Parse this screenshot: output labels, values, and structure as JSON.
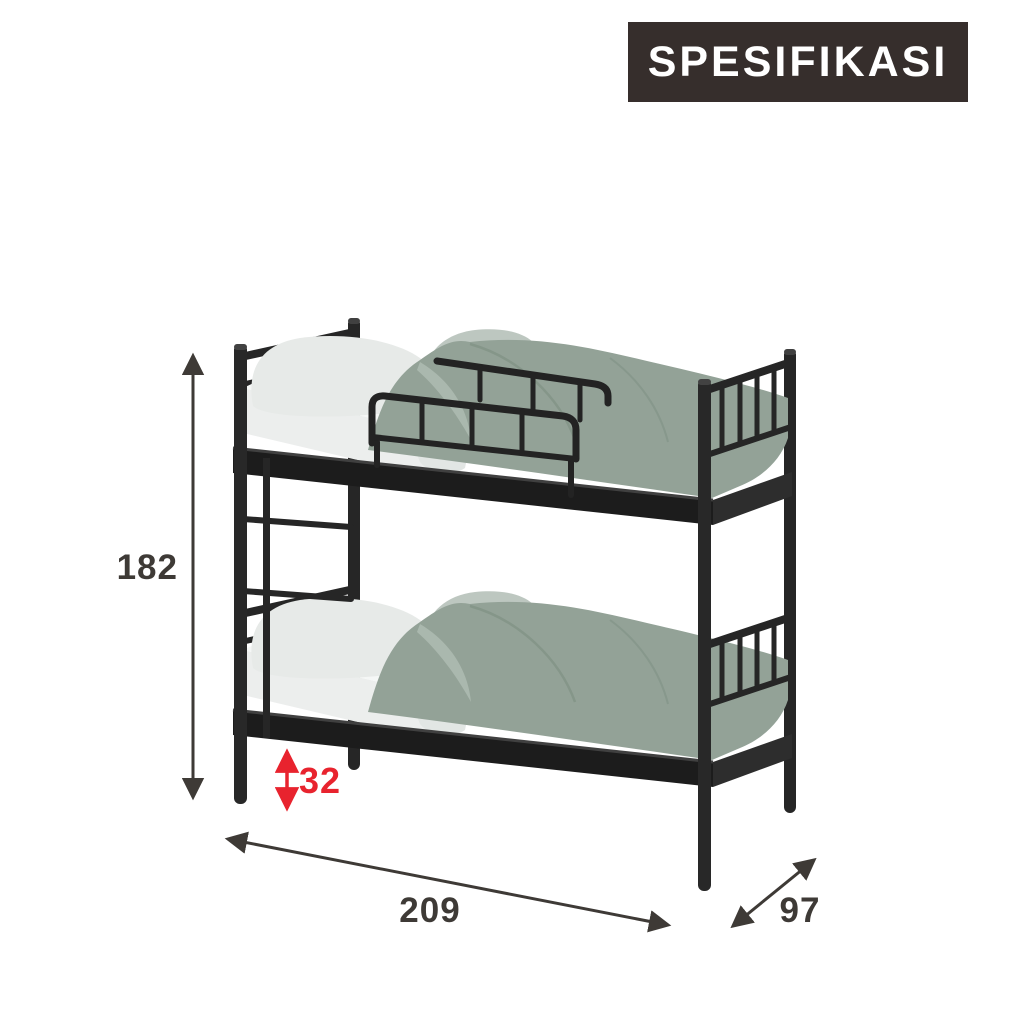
{
  "badge": {
    "label": "SPESIFIKASI"
  },
  "dimensions": {
    "height": "182",
    "clearance": "32",
    "length": "209",
    "depth": "97"
  },
  "colors": {
    "dimension_dark": "#3e3a36",
    "accent_red": "#e8232e",
    "badge_bg": "#362e2c",
    "badge_text": "#ffffff",
    "frame_black": "#262626",
    "frame_rail_dark": "#1c1c1c",
    "duvet_green": "#93a297",
    "pillow_white": "#e7eae8",
    "pillow_back_gray": "#bdc7c0",
    "mattress_white": "#eceeed",
    "background": "#ffffff"
  },
  "icons": {
    "height_arrow": "double-headed-vertical-arrow",
    "clearance_arrow": "double-headed-vertical-arrow-red",
    "length_arrow": "double-headed-diagonal-arrow",
    "depth_arrow": "double-headed-diagonal-arrow"
  }
}
